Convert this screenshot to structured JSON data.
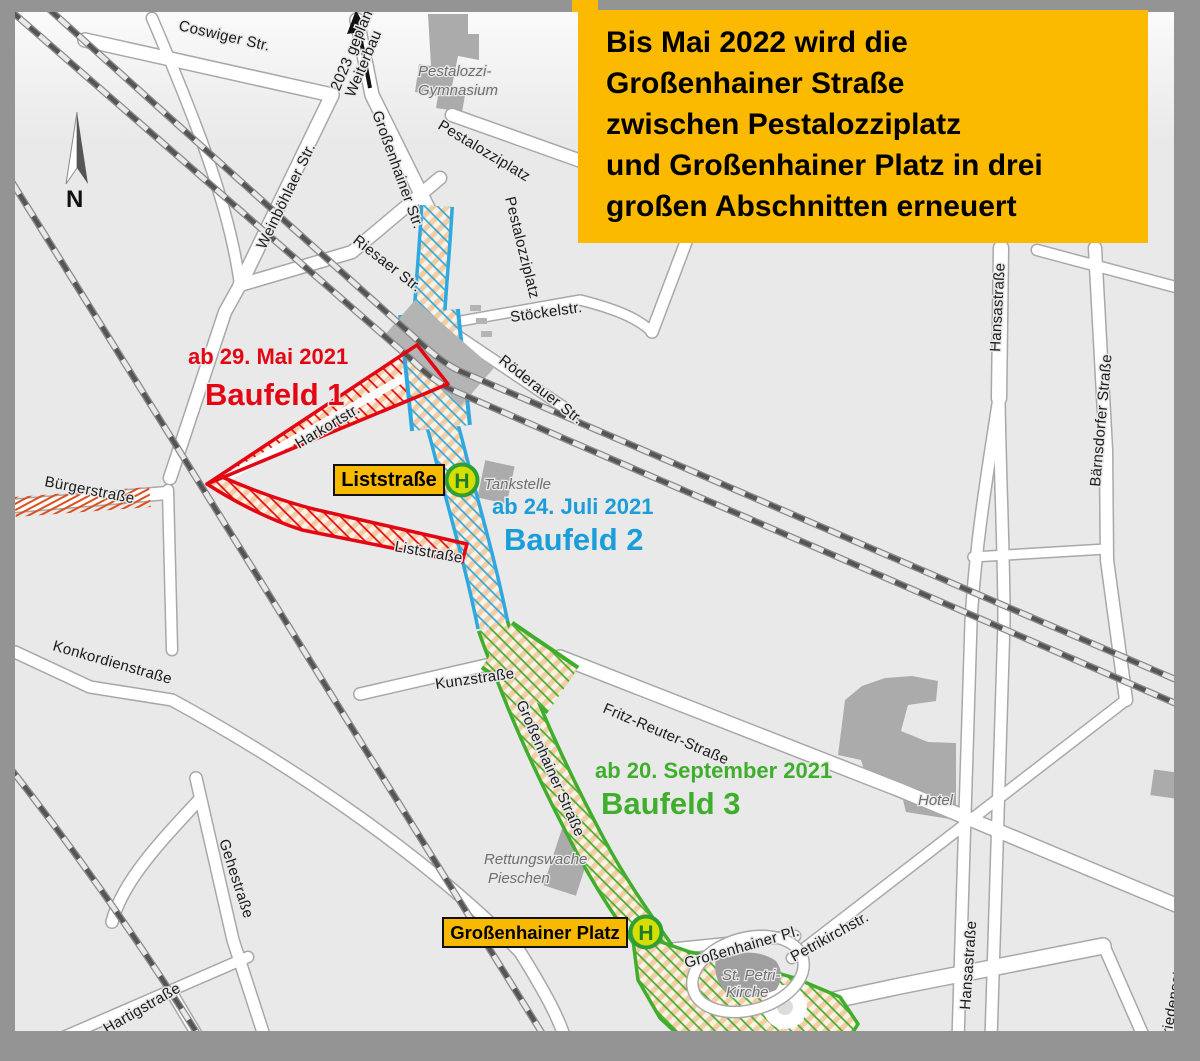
{
  "frame": {
    "color": "#949494"
  },
  "map": {
    "background": "#e9e9e9"
  },
  "info_box": {
    "bg": "#fbba00",
    "lines": [
      "Bis Mai 2022 wird die",
      "Großenhainer Straße",
      "zwischen Pestalozziplatz",
      "und Großenhainer Platz in drei",
      "großen Abschnitten erneuert"
    ]
  },
  "compass": {
    "label": "N"
  },
  "construction_note": {
    "line1": "Weiterbau",
    "line2": "2023 geplant"
  },
  "phases": {
    "baufeld1": {
      "date": "ab 29. Mai 2021",
      "title": "Baufeld 1",
      "color": "#e30613"
    },
    "baufeld2": {
      "date": "ab 24. Juli 2021",
      "title": "Baufeld 2",
      "color": "#1b9dd9"
    },
    "baufeld3": {
      "date": "ab 20. September 2021",
      "title": "Baufeld 3",
      "color": "#3fae2c"
    }
  },
  "bus_stops": {
    "liststrasse": {
      "label": "Liststraße",
      "symbol": "H"
    },
    "grossenhainer_platz": {
      "label": "Großenhainer Platz",
      "symbol": "H"
    }
  },
  "streets": {
    "coswiger": "Coswiger Str.",
    "weinboehlaer": "Weinböhlaer Str.",
    "grossenhainer_nord": "Großenhainer Str.",
    "pestalozziplatz_ost": "Pestalozziplatz",
    "pestalozziplatz_sued": "Pestalozziplatz",
    "riesaer": "Riesaer Str.",
    "stoeckelstr": "Stöckelstr.",
    "roederauer": "Röderauer Str.",
    "hansastrasse_nord": "Hansastraße",
    "baernsdorfer": "Bärnsdorfer Straße",
    "harkortstr": "Harkortstr.",
    "buergerstrasse": "Bürgerstraße",
    "liststrasse": "Liststraße",
    "konkordienstrasse": "Konkordienstraße",
    "kunzstrasse": "Kunzstraße",
    "grossenhainer_mitte": "Großenhainer Straße",
    "fritz_reuter": "Fritz-Reuter-Straße",
    "gehestrasse": "Gehestraße",
    "hartigstrasse": "Hartigstraße",
    "grossenhainer_pl": "Großenhainer Pl.",
    "petrikirchstr": "Petrikirchstr.",
    "hansastrasse_sued": "Hansastraße",
    "friedensstr": "Friedensstr."
  },
  "pois": {
    "gymnasium_line1": "Pestalozzi-",
    "gymnasium_line2": "Gymnasium",
    "tankstelle": "Tankstelle",
    "hotel": "Hotel",
    "rettungswache_line1": "Rettungswache",
    "rettungswache_line2": "Pieschen",
    "st_petri_line1": "St. Petri-",
    "st_petri_line2": "Kirche"
  }
}
